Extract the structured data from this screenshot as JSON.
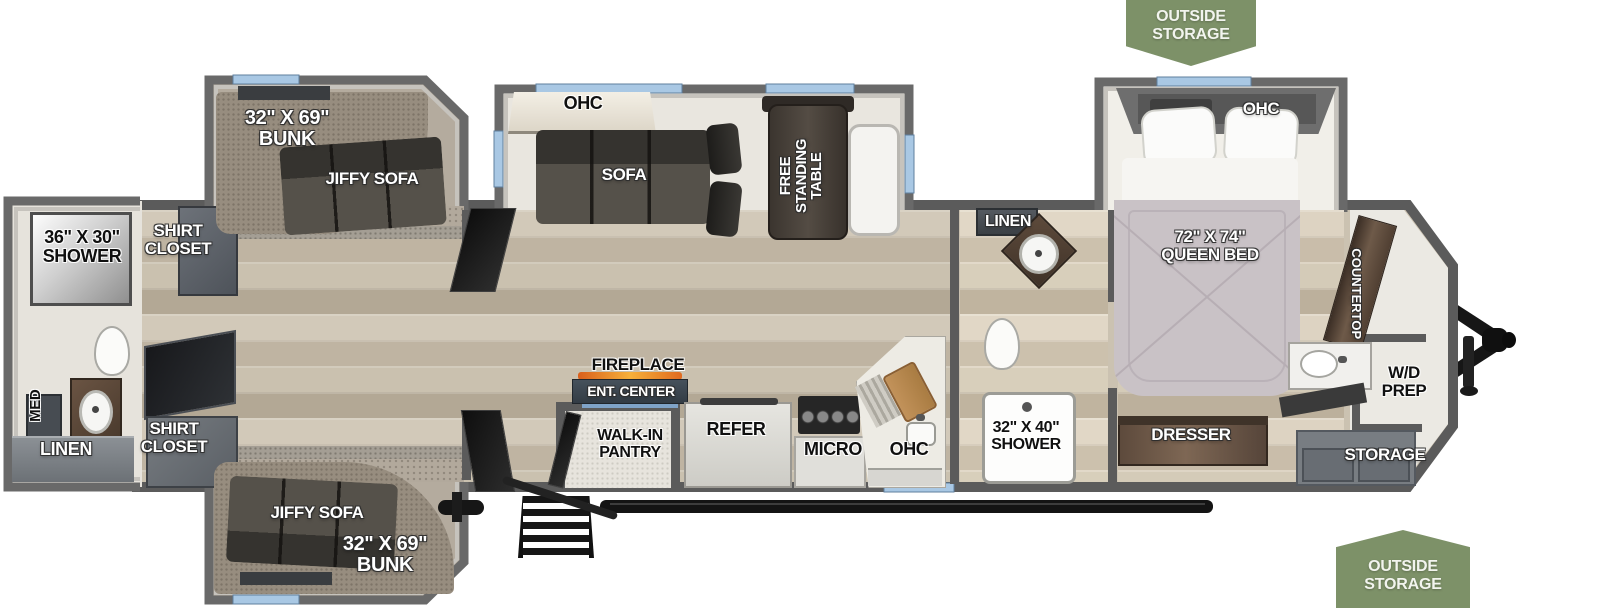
{
  "diagram": {
    "type": "rv-floorplan",
    "banners": {
      "top": "OUTSIDE\nSTORAGE",
      "bottom": "OUTSIDE\nSTORAGE"
    },
    "labels": {
      "shower_left": "36\" X 30\"\nSHOWER",
      "shirt_closet_top": "SHIRT\nCLOSET",
      "med": "MED",
      "linen_left": "LINEN",
      "shirt_closet_bottom": "SHIRT\nCLOSET",
      "bunk_top": "32\" X 69\"\nBUNK",
      "jiffy_sofa_top": "JIFFY SOFA",
      "ohc_sofa": "OHC",
      "sofa": "SOFA",
      "free_standing_table": "FREE\nSTANDING\nTABLE",
      "fireplace": "FIREPLACE",
      "ent_center": "ENT. CENTER",
      "walk_in_pantry": "WALK-IN\nPANTRY",
      "refer": "REFER",
      "micro": "MICRO",
      "ohc_kitchen": "OHC",
      "linen_mid": "LINEN",
      "shower_mid": "32\" X 40\"\nSHOWER",
      "ohc_bedroom": "OHC",
      "queen_bed": "72\" X 74\"\nQUEEN BED",
      "countertop": "COUNTERTOP",
      "wd_prep": "W/D\nPREP",
      "dresser": "DRESSER",
      "storage": "STORAGE",
      "jiffy_sofa_bottom": "JIFFY SOFA",
      "bunk_bottom": "32\" X 69\"\nBUNK"
    },
    "colors": {
      "banner_green": "#7d9168",
      "window_blue": "#a9c8e4",
      "wall_gray": "#5b5b5b",
      "wood_floor": "#c8bfae",
      "carpet": "#b2a99c"
    }
  }
}
